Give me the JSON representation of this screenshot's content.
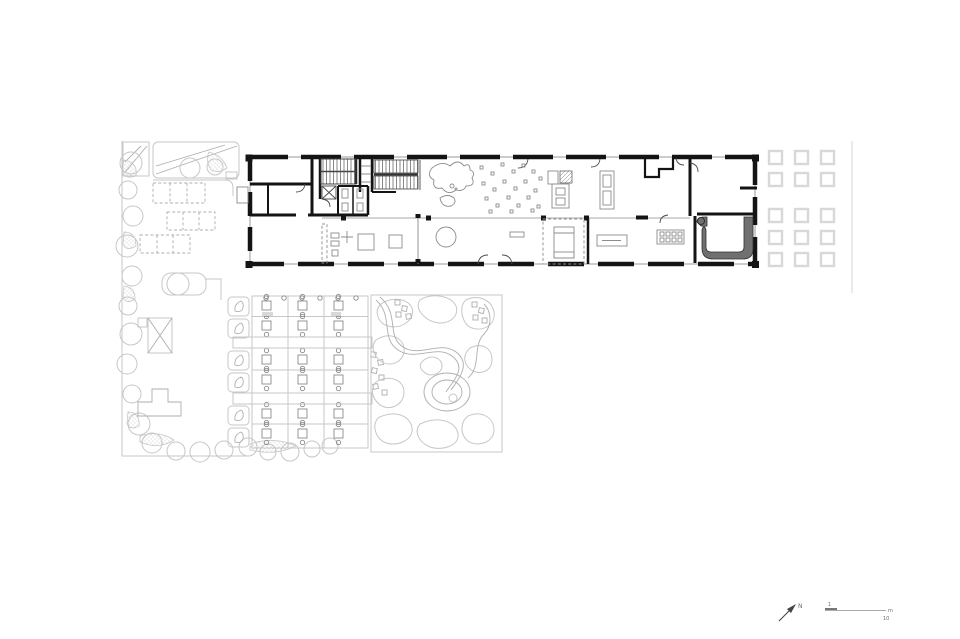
{
  "annotations": {
    "north_label": "N",
    "scale_bar": {
      "start_label": "1",
      "unit_label": "m",
      "end_label": "10"
    }
  },
  "colors": {
    "background": "#ffffff",
    "wall": "#141414",
    "interior_line": "#4a4a4a",
    "furniture_line": "#8c8c8c",
    "garden_line": "#c7c7c7",
    "garden_line_dark": "#aeaeae",
    "stipple_dot": "#b0b0b0",
    "ramp_fill": "#707070",
    "ramp_edge": "#303030",
    "column_square": "#d8d8d8",
    "boundary_line": "#e0e0e0",
    "annotation": "#6e6e6e"
  }
}
